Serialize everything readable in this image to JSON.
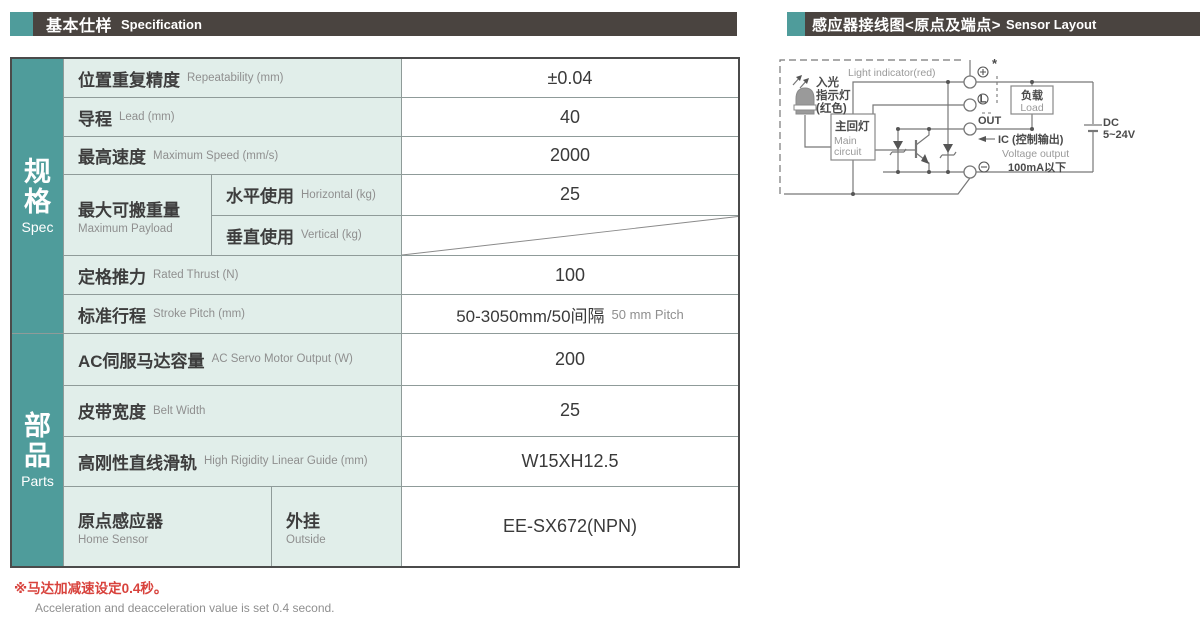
{
  "colors": {
    "teal": "#4f9c9b",
    "bar": "#4a4440",
    "cellbg": "#e1eeea",
    "line": "#8f9b99",
    "red": "#d8423c"
  },
  "header_left": {
    "title_cn": "基本仕样",
    "title_en": "Specification"
  },
  "header_right": {
    "title_cn": "感应器接线图<原点及端点>",
    "title_en": "Sensor Layout"
  },
  "table": {
    "sections": [
      {
        "label_cn": "规格",
        "label_en": "Spec"
      },
      {
        "label_cn": "部品",
        "label_en": "Parts"
      }
    ],
    "rows": {
      "repeatability": {
        "cn": "位置重复精度",
        "en": "Repeatability (mm)",
        "value": "±0.04"
      },
      "lead": {
        "cn": "导程",
        "en": "Lead (mm)",
        "value": "40"
      },
      "max_speed": {
        "cn": "最高速度",
        "en": "Maximum Speed (mm/s)",
        "value": "2000"
      },
      "payload": {
        "cn": "最大可搬重量",
        "en": "Maximum Payload",
        "horizontal": {
          "cn": "水平使用",
          "en": "Horizontal (kg)",
          "value": "25"
        },
        "vertical": {
          "cn": "垂直使用",
          "en": "Vertical (kg)",
          "value": ""
        }
      },
      "thrust": {
        "cn": "定格推力",
        "en": "Rated Thrust (N)",
        "value": "100"
      },
      "stroke": {
        "cn": "标准行程",
        "en": "Stroke Pitch (mm)",
        "value_cn": "50-3050mm/50间隔",
        "value_en": "50 mm Pitch"
      },
      "servo": {
        "cn": "AC伺服马达容量",
        "en": "AC Servo Motor Output (W)",
        "value": "200"
      },
      "belt": {
        "cn": "皮带宽度",
        "en": "Belt Width",
        "value": "25"
      },
      "guide": {
        "cn": "高刚性直线滑轨",
        "en": "High Rigidity Linear Guide (mm)",
        "value": "W15XH12.5"
      },
      "home_sensor": {
        "cn": "原点感应器",
        "en": "Home Sensor",
        "mount_cn": "外挂",
        "mount_en": "Outside",
        "value": "EE-SX672(NPN)"
      }
    }
  },
  "note": {
    "cn": "※马达加减速设定0.4秒。",
    "en": "Acceleration and deacceleration value is set 0.4 second."
  },
  "diagram": {
    "light_indicator_en": "Light indicator(red)",
    "light_cn_1": "入光",
    "light_cn_2": "指示灯",
    "light_cn_3": "(红色)",
    "main_circuit_cn": "主回灯",
    "main_circuit_en_1": "Main",
    "main_circuit_en_2": "circuit",
    "terminal_plus_star": "*",
    "terminal_l": "L",
    "out_label": "OUT",
    "ic_label": "IC (控制输出)",
    "voltage_output": "Voltage output",
    "current_limit": "100mA以下",
    "load_cn": "负载",
    "load_en": "Load",
    "dc_line1": "DC",
    "dc_line2": "5~24V"
  }
}
